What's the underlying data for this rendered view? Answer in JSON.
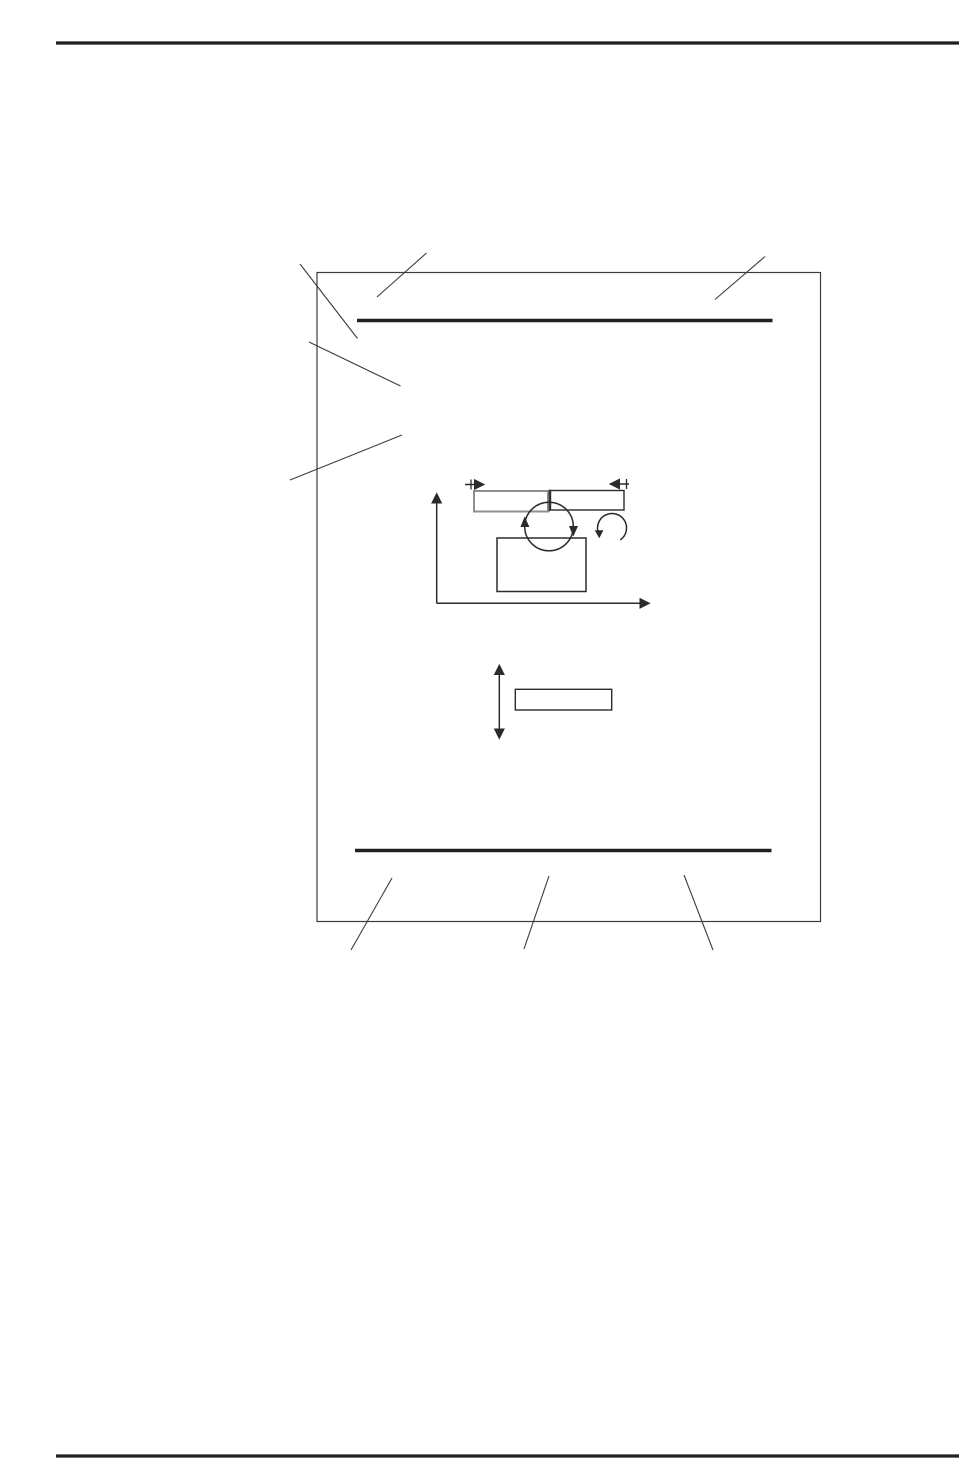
{
  "page": {
    "width": 959,
    "height": 1458,
    "background": "#ffffff",
    "ink_color": "#231f20",
    "thin_line_color": "#3c3c3c",
    "gray_accent_color": "#8f8f8f",
    "visible_text": []
  },
  "shapes": [
    {
      "name": "header-rule",
      "kind": "line",
      "attrs": {
        "x1": 56,
        "y1": 43,
        "x2": 959,
        "y2": 43,
        "stroke": "#231f20",
        "stroke-width": 3.2
      }
    },
    {
      "name": "footer-rule",
      "kind": "line",
      "attrs": {
        "x1": 56,
        "y1": 1456,
        "x2": 959,
        "y2": 1456,
        "stroke": "#231f20",
        "stroke-width": 3.2
      }
    },
    {
      "name": "figure-frame",
      "kind": "rect",
      "attrs": {
        "x": 317,
        "y": 272.5,
        "width": 503.5,
        "height": 649,
        "fill": "none",
        "stroke": "#3c3c3c",
        "stroke-width": 1.2
      }
    },
    {
      "name": "figure-top-bar",
      "kind": "line",
      "attrs": {
        "x1": 357,
        "y1": 320.5,
        "x2": 772.5,
        "y2": 320.5,
        "stroke": "#231f20",
        "stroke-width": 3.4
      }
    },
    {
      "name": "figure-bottom-bar",
      "kind": "line",
      "attrs": {
        "x1": 355,
        "y1": 850.5,
        "x2": 771.5,
        "y2": 850.5,
        "stroke": "#231f20",
        "stroke-width": 3.4
      }
    },
    {
      "name": "callout-line-top-left-corner",
      "kind": "line",
      "attrs": {
        "x1": 300,
        "y1": 264,
        "x2": 357.5,
        "y2": 338.5,
        "stroke": "#3c3c3c",
        "stroke-width": 1.1
      }
    },
    {
      "name": "callout-line-top-bar",
      "kind": "line",
      "attrs": {
        "x1": 377,
        "y1": 297,
        "x2": 426.5,
        "y2": 253,
        "stroke": "#3c3c3c",
        "stroke-width": 1.1
      }
    },
    {
      "name": "callout-line-top-right",
      "kind": "line",
      "attrs": {
        "x1": 715,
        "y1": 299.5,
        "x2": 765,
        "y2": 256.5,
        "stroke": "#3c3c3c",
        "stroke-width": 1.1
      }
    },
    {
      "name": "callout-line-mid-left",
      "kind": "line",
      "attrs": {
        "x1": 309,
        "y1": 342,
        "x2": 400.5,
        "y2": 386,
        "stroke": "#3c3c3c",
        "stroke-width": 1.1
      }
    },
    {
      "name": "callout-line-lower-left",
      "kind": "line",
      "attrs": {
        "x1": 290,
        "y1": 480,
        "x2": 402,
        "y2": 435,
        "stroke": "#3c3c3c",
        "stroke-width": 1.1
      }
    },
    {
      "name": "callout-line-bottom-left",
      "kind": "line",
      "attrs": {
        "x1": 392,
        "y1": 878,
        "x2": 351,
        "y2": 950,
        "stroke": "#3c3c3c",
        "stroke-width": 1.1
      }
    },
    {
      "name": "callout-line-bottom-center",
      "kind": "line",
      "attrs": {
        "x1": 549,
        "y1": 876,
        "x2": 524,
        "y2": 949,
        "stroke": "#3c3c3c",
        "stroke-width": 1.1
      }
    },
    {
      "name": "callout-line-bottom-right",
      "kind": "line",
      "attrs": {
        "x1": 684,
        "y1": 875,
        "x2": 713,
        "y2": 950,
        "stroke": "#3c3c3c",
        "stroke-width": 1.1
      }
    },
    {
      "name": "y-axis-arrow",
      "kind": "line",
      "marker_end": true,
      "attrs": {
        "x1": 436.7,
        "y1": 603.3,
        "x2": 436.7,
        "y2": 494,
        "stroke": "#2b2b2b",
        "stroke-width": 1.5
      }
    },
    {
      "name": "x-axis-arrow",
      "kind": "line",
      "marker_end": true,
      "attrs": {
        "x1": 436.7,
        "y1": 603.3,
        "x2": 649,
        "y2": 603.3,
        "stroke": "#2b2b2b",
        "stroke-width": 1.5
      }
    },
    {
      "name": "feed-direction-arrow-left",
      "kind": "line",
      "marker_end": true,
      "attrs": {
        "x1": 465,
        "y1": 484.5,
        "x2": 483.5,
        "y2": 484.5,
        "stroke": "#2b2b2b",
        "stroke-width": 1.5
      }
    },
    {
      "name": "feed-tick-left",
      "kind": "line",
      "attrs": {
        "x1": 471,
        "y1": 479.5,
        "x2": 471,
        "y2": 489.5,
        "stroke": "#2b2b2b",
        "stroke-width": 1.3
      }
    },
    {
      "name": "feed-direction-arrow-right",
      "kind": "line",
      "marker_end": true,
      "attrs": {
        "x1": 629,
        "y1": 484,
        "x2": 610.5,
        "y2": 484,
        "stroke": "#2b2b2b",
        "stroke-width": 1.5
      }
    },
    {
      "name": "feed-tick-right",
      "kind": "line",
      "attrs": {
        "x1": 626.5,
        "y1": 479,
        "x2": 626.5,
        "y2": 489,
        "stroke": "#2b2b2b",
        "stroke-width": 1.3
      }
    },
    {
      "name": "tray-rect-left",
      "kind": "rect",
      "attrs": {
        "x": 474,
        "y": 491,
        "width": 74,
        "height": 20.5,
        "fill": "none",
        "stroke": "#8f8f8f",
        "stroke-width": 2
      }
    },
    {
      "name": "tray-rect-right",
      "kind": "rect",
      "attrs": {
        "x": 550.5,
        "y": 490.5,
        "width": 73.5,
        "height": 19.5,
        "fill": "none",
        "stroke": "#2b2b2b",
        "stroke-width": 1.4
      }
    },
    {
      "name": "tray-divider-line",
      "kind": "line",
      "attrs": {
        "x1": 549.3,
        "y1": 489.5,
        "x2": 549.3,
        "y2": 511.5,
        "stroke": "#2b2b2b",
        "stroke-width": 1.2
      }
    },
    {
      "name": "drum-circle",
      "kind": "circle",
      "attrs": {
        "cx": 549,
        "cy": 526.5,
        "r": 24.3,
        "fill": "none",
        "stroke": "#2b2b2b",
        "stroke-width": 1.5
      }
    },
    {
      "name": "drum-rotation-arrowhead-left-up",
      "kind": "polygon",
      "attrs": {
        "points": "524.7,516.5 520.4,527 529.4,527",
        "fill": "#2b2b2b",
        "stroke": "none"
      }
    },
    {
      "name": "drum-rotation-arrowhead-right-down",
      "kind": "polygon",
      "attrs": {
        "points": "573.3,536.5 569,526 578,526",
        "fill": "#2b2b2b",
        "stroke": "none"
      }
    },
    {
      "name": "counter-rotation-arc",
      "kind": "path",
      "attrs": {
        "d": "M 620.3 539.9 A 14.5 14.5 0 1 0 598.9 534.1",
        "fill": "none",
        "stroke": "#2b2b2b",
        "stroke-width": 1.5
      }
    },
    {
      "name": "counter-rotation-arc-arrowhead",
      "kind": "polygon",
      "attrs": {
        "points": "599.3,538.3 594.7,530.2 603.4,530.2",
        "fill": "#2b2b2b",
        "stroke": "none"
      }
    },
    {
      "name": "printer-body-rect",
      "kind": "rect",
      "attrs": {
        "x": 497,
        "y": 538,
        "width": 89,
        "height": 53.5,
        "fill": "none",
        "stroke": "#2b2b2b",
        "stroke-width": 1.5
      }
    },
    {
      "name": "vertical-range-double-arrow",
      "kind": "line",
      "marker_start": true,
      "marker_end": true,
      "attrs": {
        "x1": 499.3,
        "y1": 665.5,
        "x2": 499.3,
        "y2": 738,
        "stroke": "#2b2b2b",
        "stroke-width": 1.5
      }
    },
    {
      "name": "elevation-rect",
      "kind": "rect",
      "attrs": {
        "x": 515.3,
        "y": 689.3,
        "width": 96.4,
        "height": 20.7,
        "fill": "none",
        "stroke": "#2b2b2b",
        "stroke-width": 1.4
      }
    }
  ]
}
